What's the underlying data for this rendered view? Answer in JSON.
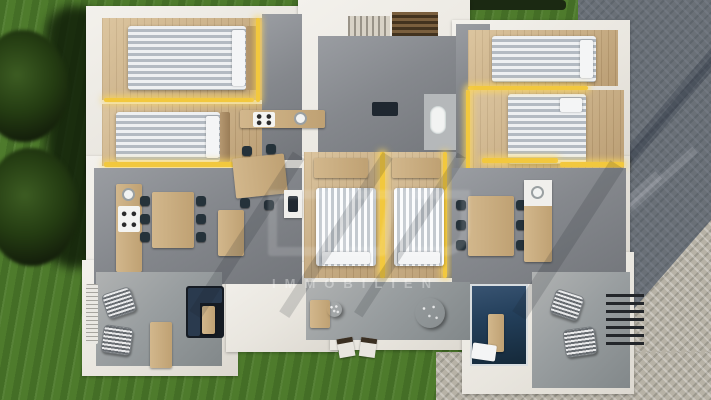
{
  "meta": {
    "width": 711,
    "height": 400,
    "kind": "aerial-3d-floorplan-render"
  },
  "watermark": {
    "text": "IMMOBILIEN"
  },
  "palette": {
    "grass": "#4e7b2c",
    "grass_shadow": "#2c4a18",
    "tree_foliage": "#1a2a0f",
    "pavement_light": "#b7b2a6",
    "pavement_shadow": "#4e5f78",
    "wall_white": "#ece9e2",
    "accent_yellow": "#f2c83e",
    "concrete_floor": "#85888d",
    "terrace_floor": "#999ea0",
    "wood_floor": "#c9ae84",
    "bed_white": "#eef0f2",
    "bed_stripe": "#b3bac2",
    "seat_dark": "#25323a",
    "pool_navy": "#1f3a55",
    "stair_brown": "#5a4630"
  },
  "inventory": {
    "bedrooms": 6,
    "beds": 6,
    "dining_tables": 3,
    "kitchen_counters": 3,
    "terraces": 3,
    "plunge_pools": 1,
    "wicker_lounge_chairs": 4,
    "outdoor_sofas": 1,
    "staircases": 1,
    "trees": 2,
    "pergola_shadow_slats": 1
  }
}
